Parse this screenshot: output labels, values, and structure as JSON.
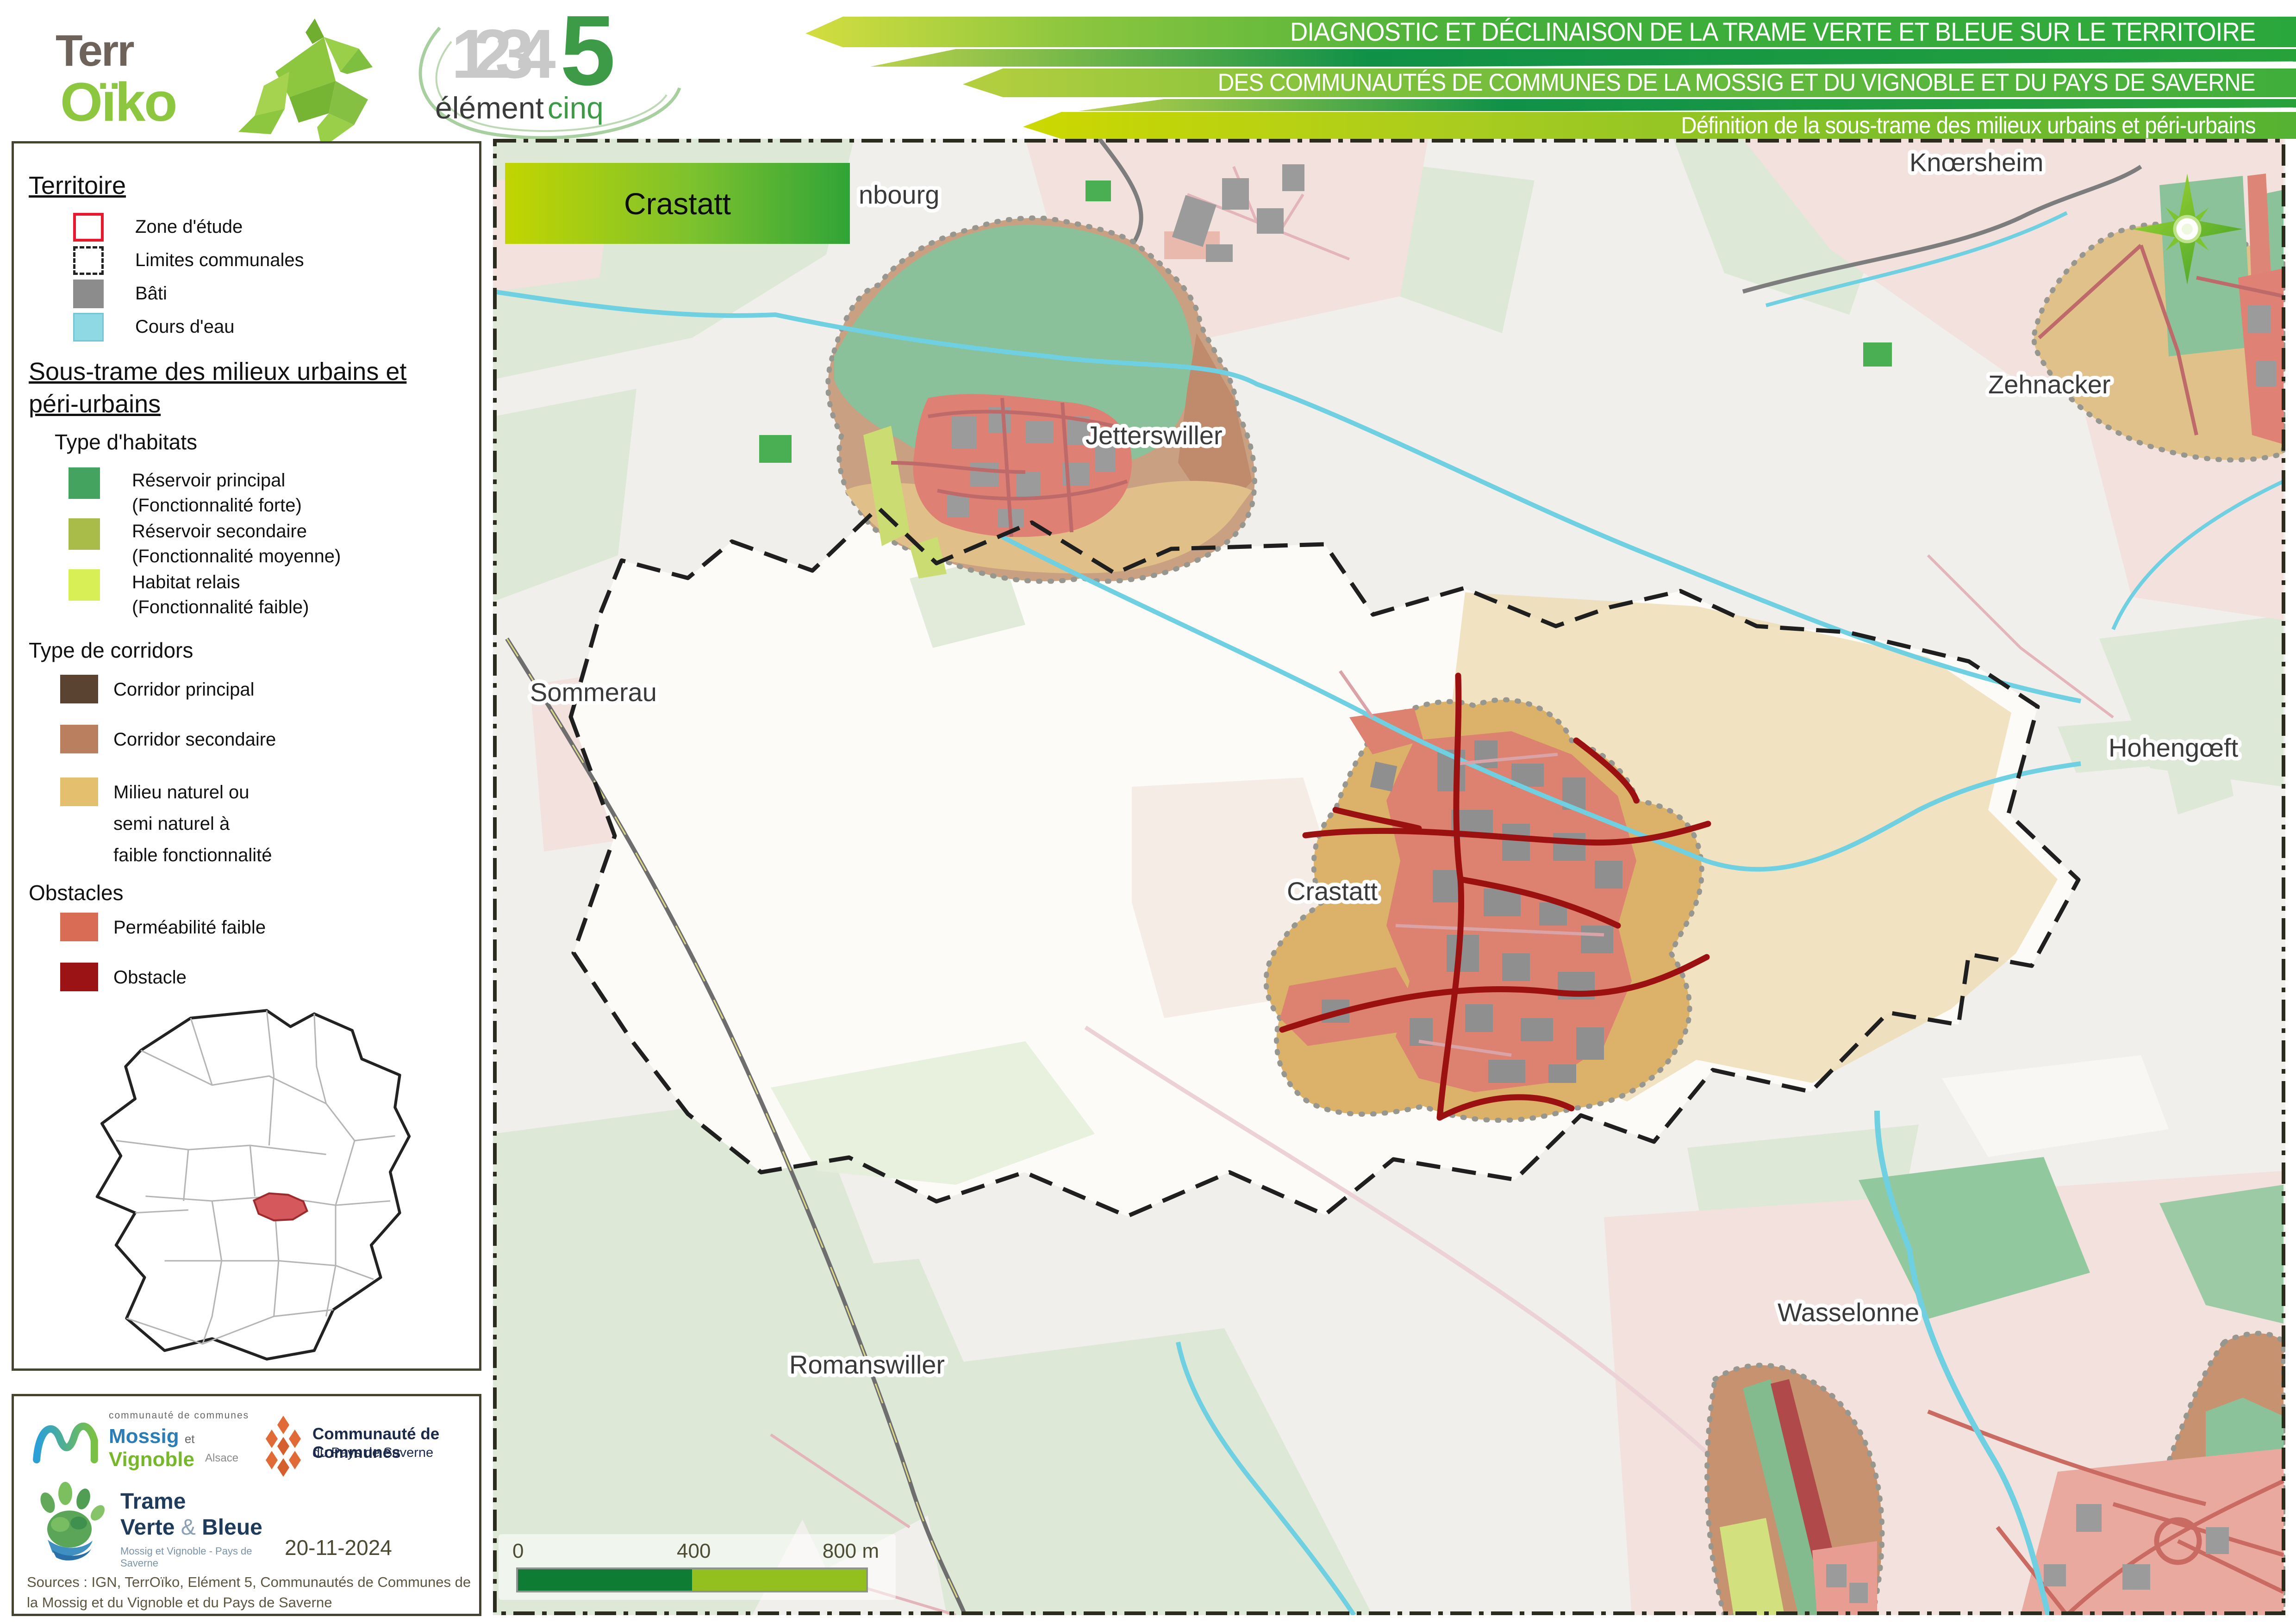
{
  "branding": {
    "terroiko": {
      "part1": "Terr",
      "part2": "Oïko"
    },
    "element5": {
      "numbers": "1234",
      "five": "5",
      "word1": "élément",
      "word2": "cinq"
    }
  },
  "header": {
    "line1": "DIAGNOSTIC ET DÉCLINAISON DE LA TRAME VERTE ET BLEUE SUR LE TERRITOIRE",
    "line2": "DES COMMUNAUTÉS DE COMMUNES DE LA MOSSIG ET DU VIGNOBLE ET DU PAYS DE SAVERNE",
    "line3": "Définition de la sous-trame des milieux urbains et péri-urbains"
  },
  "legend": {
    "territoire": {
      "title": "Territoire",
      "items": [
        {
          "label": "Zone d'étude",
          "color": "#e8192c"
        },
        {
          "label": "Limites communales",
          "color": "#222222"
        },
        {
          "label": "Bâti",
          "color": "#8c8c8c"
        },
        {
          "label": "Cours d'eau",
          "color": "#8fd9e4"
        }
      ]
    },
    "soustrame": {
      "title_line1": "Sous-trame des milieux urbains et",
      "title_line2": "péri-urbains"
    },
    "habitats": {
      "title": "Type d'habitats",
      "items": [
        {
          "label": "Réservoir principal",
          "sub": "(Fonctionnalité forte)",
          "color": "#44a45f"
        },
        {
          "label": "Réservoir secondaire",
          "sub": "(Fonctionnalité moyenne)",
          "color": "#a9bc4a"
        },
        {
          "label": "Habitat relais",
          "sub": "(Fonctionnalité faible)",
          "color": "#d9ef56"
        }
      ]
    },
    "corridors": {
      "title": "Type de corridors",
      "items": [
        {
          "label": "Corridor principal",
          "color": "#5a4330"
        },
        {
          "label": "Corridor secondaire",
          "color": "#b97f5e"
        },
        {
          "label": "Milieu naturel ou",
          "label2": "semi naturel à",
          "label3": "faible fonctionnalité",
          "color": "#e4bf6e"
        }
      ]
    },
    "obstacles": {
      "title": "Obstacles",
      "items": [
        {
          "label": "Perméabilité faible",
          "color": "#d96c55"
        },
        {
          "label": "Obstacle",
          "color": "#9b1315"
        }
      ]
    }
  },
  "map": {
    "title_box": "Crastatt",
    "labels": [
      "nbourg",
      "Knœrsheim",
      "Jetterswiller",
      "Zehnacker",
      "Sommerau",
      "Hohengœft",
      "Crastatt",
      "Wasselonne",
      "Romanswiller"
    ],
    "scalebar": {
      "tick0": "0",
      "tick400": "400",
      "tick800": "800 m"
    }
  },
  "credits": {
    "mossig": {
      "top": "communauté de communes",
      "name1": "Mossig",
      "et": "et",
      "name2": "Vignoble",
      "region": "Alsace"
    },
    "saverne": {
      "line1": "Communauté de Communes",
      "line2": "du Pays de Saverne"
    },
    "tvb": {
      "line1": "Trame",
      "line2a": "Verte",
      "amp": "&",
      "line2b": "Bleue",
      "sub": "Mossig et Vignoble - Pays de Saverne"
    },
    "date": "20-11-2024",
    "sources_line1": "Sources : IGN, TerrOïko, Elément 5, Communautés de Communes de",
    "sources_line2": "la Mossig et du Vignoble et du Pays de Saverne"
  },
  "colors": {
    "banner_green_dark": "#2aa73c",
    "banner_green_mid": "#7fc13c",
    "banner_yellow": "#ccd800",
    "reservoir_principal": "#44a45f",
    "reservoir_secondaire": "#a9bc4a",
    "habitat_relais": "#d9ef56",
    "corridor_principal": "#5a4330",
    "corridor_secondaire": "#b97f5e",
    "milieu_faible": "#e4bf6e",
    "permeabilite_faible": "#d96c55",
    "obstacle": "#9b1315",
    "bati": "#8c8c8c",
    "cours_eau": "#8fd9e4",
    "zone_etude": "#e8192c",
    "map_tan_blob": "#dcb26a",
    "map_salmon": "#dd8170",
    "map_road_dark_red": "#9b1111",
    "map_green_reservoir": "#8ac09a",
    "inset_highlight": "#d4585c"
  }
}
